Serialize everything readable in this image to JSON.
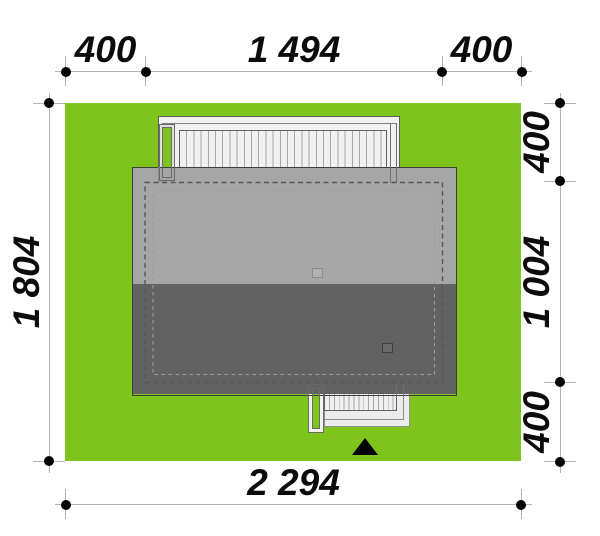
{
  "drawing": {
    "type": "house-site-plan",
    "dimensions": {
      "top": [
        "400",
        "1 494",
        "400"
      ],
      "right": [
        "400",
        "1 004",
        "400"
      ],
      "left": [
        "1 804"
      ],
      "bottom": [
        "2 294"
      ]
    },
    "colors": {
      "grass": "#7ec41d",
      "roof_light": "#a6a6a6",
      "roof_dark": "#626262",
      "paving": "#f1f1f1",
      "dimension_line": "#b3b3b3",
      "dimension_text": "#0c0c0c",
      "entrance_marker": "#000000"
    }
  }
}
